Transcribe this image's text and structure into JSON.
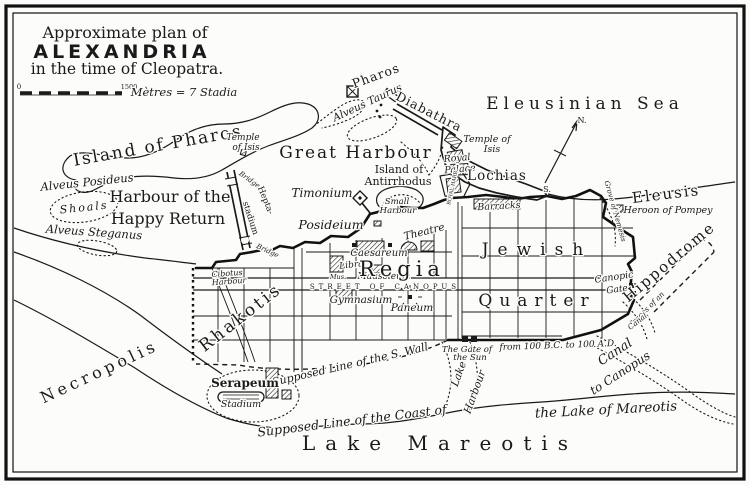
{
  "colors": {
    "ink": "#1a1a1a",
    "paper": "#fcfcfa"
  },
  "title": {
    "line1": "Approximate plan of",
    "line2": "ALEXANDRIA",
    "line3": "in the time of Cleopatra."
  },
  "scale": {
    "zero": "0",
    "value": "1500",
    "unit": "Mètres = 7 Stadia"
  },
  "compass": {
    "north": "N.",
    "south": "S."
  },
  "labels": {
    "island_of_pharos": "Island of Pharos",
    "temple_isis_island_1": "Temple",
    "temple_isis_island_2": "of Isis",
    "pharos": "Pharos",
    "alveus_taurus": "Alveus Taurus",
    "diabathra": "Diabathra",
    "eleusinian_sea": "Eleusinian Sea",
    "great_harbour": "Great Harbour",
    "harbour_of_the": "Harbour of the",
    "happy_return": "Happy Return",
    "alveus_posideus": "Alveus Posideus",
    "shoals": "Shoals",
    "alveus_steganus": "Alveus Steganus",
    "bridge_north": "Bridge",
    "bridge_south": "Bridge",
    "heptastadium_1": "Hepta-",
    "heptastadium_2": "stadium",
    "timonium": "Timonium",
    "posideium": "Posideium",
    "island_of": "Island of",
    "antirrhodus": "Antirrhodus",
    "small_harbour_1": "Small",
    "small_harbour_2": "Harbour",
    "temple_isis_lochias_1": "Temple of",
    "temple_isis_lochias_2": "Isis",
    "royal_palace_1": "Royal",
    "royal_palace_2": "Palace",
    "lochias": "Lochias",
    "royal_harbour": "ROYAL HARB.",
    "barracks": "Barracks",
    "eleusis": "Eleusis",
    "heroon_of_pompey": "Heroon of Pompey",
    "grove_of_nemesis": "Grove of Nemesis",
    "hippodrome": "Hippodrome",
    "canopic": "Canopic",
    "canopic_gate": "Gate",
    "traces_1": "Traces of an",
    "traces_2": "Canal",
    "canal_1": "Canal",
    "canal_2": "to Canopus",
    "theatre": "Theatre",
    "caesareum": "Caesareum",
    "library": "Library",
    "museum": "Mus.",
    "mausoleum": "Mausoleum",
    "regia": "Regia",
    "street_of_canopus": "STREET OF CANOPUS",
    "gymnasium": "Gymnasium",
    "paneum": "Paneum",
    "jewish": "Jewish",
    "quarter": "Quarter",
    "rhakotis": "Rhakotis",
    "cibotus_1": "Cibotus",
    "cibotus_2": "Harbour",
    "gate_of_sun_1": "The Gate of",
    "gate_of_sun_2": "the Sun",
    "from_100": "from 100 B.C. to 100 A.D.",
    "s_wall": "Supposed Line of the S. Wall",
    "lake_harbour_1": "Lake",
    "lake_harbour_2": "Harbour",
    "lake_of_mareotis": "the Lake of Mareotis",
    "coast_of": "Supposed Line of the Coast of",
    "lake_mareotis": "Lake Mareotis",
    "necropolis": "Necropolis",
    "serapeum": "Serapeum",
    "stadium": "Stadium"
  }
}
